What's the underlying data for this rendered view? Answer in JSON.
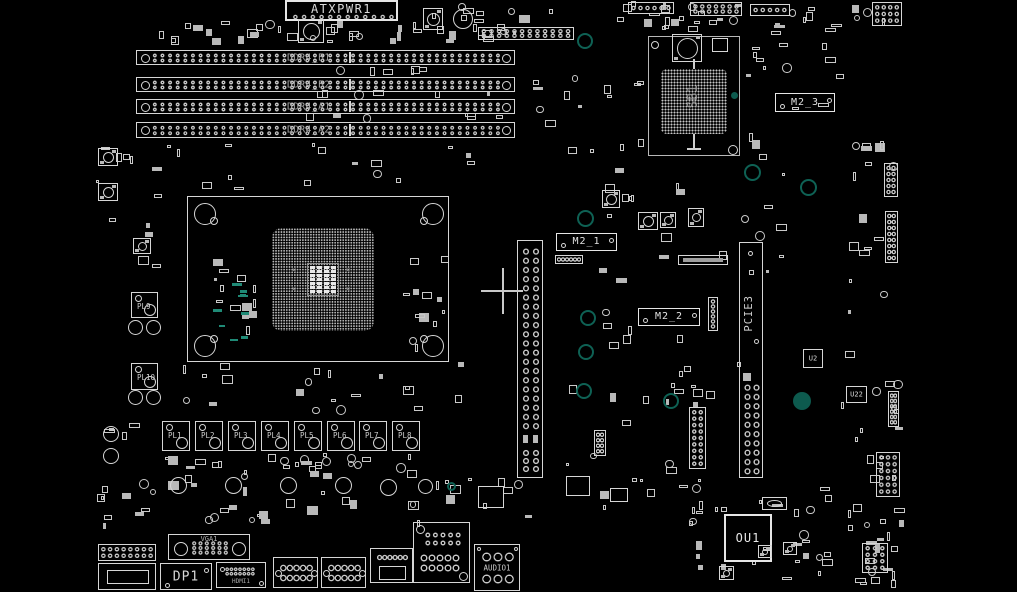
{
  "app": {
    "type": "pcb-boardview",
    "background": "#000000"
  },
  "colors": {
    "outline": "#d6d6d6",
    "bright": "#e6e6e6",
    "label": "#cfcfcf",
    "dim_label": "#a8a8a8",
    "teal_ring": "#0e6154",
    "teal_fill": "#0d5a4e",
    "teal_text": "#1f8a76",
    "cursor": "#c9c9c9"
  },
  "cursor": {
    "x": 503,
    "y": 291
  },
  "components": [
    {
      "t": "scatter",
      "x": 140,
      "y": 16,
      "w": 145,
      "h": 30,
      "n": 14
    },
    {
      "t": "scatter",
      "x": 285,
      "y": 20,
      "w": 250,
      "h": 24,
      "n": 20
    },
    {
      "t": "scatter",
      "x": 420,
      "y": 0,
      "w": 115,
      "h": 44,
      "n": 12
    },
    {
      "t": "scatter",
      "x": 548,
      "y": 0,
      "w": 215,
      "h": 26,
      "n": 13
    },
    {
      "t": "scatter",
      "x": 770,
      "y": 0,
      "w": 140,
      "h": 34,
      "n": 12
    },
    {
      "t": "scatter",
      "x": 95,
      "y": 140,
      "w": 68,
      "h": 128,
      "n": 12
    },
    {
      "t": "scatter",
      "x": 165,
      "y": 142,
      "w": 330,
      "h": 52,
      "n": 16
    },
    {
      "t": "scatter",
      "x": 520,
      "y": 48,
      "w": 125,
      "h": 135,
      "n": 16
    },
    {
      "t": "scatter",
      "x": 742,
      "y": 30,
      "w": 120,
      "h": 135,
      "n": 16
    },
    {
      "t": "scatter",
      "x": 640,
      "y": 16,
      "w": 100,
      "h": 18,
      "n": 8
    },
    {
      "t": "scatter",
      "x": 205,
      "y": 252,
      "w": 52,
      "h": 92,
      "n": 13
    },
    {
      "t": "scatter",
      "x": 400,
      "y": 245,
      "w": 52,
      "h": 108,
      "n": 12
    },
    {
      "t": "scatter",
      "x": 212,
      "y": 282,
      "w": 40,
      "h": 62,
      "n": 9,
      "teal": true
    },
    {
      "t": "scatter",
      "x": 168,
      "y": 362,
      "w": 300,
      "h": 52,
      "n": 20
    },
    {
      "t": "scatter",
      "x": 158,
      "y": 452,
      "w": 265,
      "h": 20,
      "n": 24
    },
    {
      "t": "scatter",
      "x": 95,
      "y": 420,
      "w": 70,
      "h": 118,
      "n": 12
    },
    {
      "t": "scatter",
      "x": 95,
      "y": 470,
      "w": 610,
      "h": 58,
      "n": 48
    },
    {
      "t": "scatter",
      "x": 690,
      "y": 478,
      "w": 168,
      "h": 112,
      "n": 28
    },
    {
      "t": "scatter",
      "x": 845,
      "y": 140,
      "w": 60,
      "h": 330,
      "n": 26
    },
    {
      "t": "scatter",
      "x": 840,
      "y": 400,
      "w": 65,
      "h": 185,
      "n": 14
    },
    {
      "t": "scatter",
      "x": 640,
      "y": 330,
      "w": 115,
      "h": 78,
      "n": 12
    },
    {
      "t": "scatter",
      "x": 560,
      "y": 300,
      "w": 118,
      "h": 175,
      "n": 13
    },
    {
      "t": "scatter",
      "x": 300,
      "y": 66,
      "w": 215,
      "h": 10,
      "n": 6
    },
    {
      "t": "scatter",
      "x": 300,
      "y": 90,
      "w": 215,
      "h": 8,
      "n": 6
    },
    {
      "t": "scatter",
      "x": 300,
      "y": 113,
      "w": 215,
      "h": 8,
      "n": 6
    },
    {
      "t": "scatter",
      "x": 555,
      "y": 170,
      "w": 245,
      "h": 125,
      "n": 20
    },
    {
      "t": "scatter",
      "x": 858,
      "y": 520,
      "w": 48,
      "h": 70,
      "n": 10
    },
    {
      "t": "atx",
      "x": 285,
      "y": 0,
      "w": 113,
      "h": 21,
      "label": "ATXPWR1"
    },
    {
      "t": "dimm",
      "x": 136,
      "y": 50,
      "w": 379,
      "h": 15,
      "label": "DDR4_B1"
    },
    {
      "t": "dimm",
      "x": 136,
      "y": 77,
      "w": 379,
      "h": 15,
      "label": "DDR4_B2"
    },
    {
      "t": "dimm",
      "x": 136,
      "y": 99,
      "w": 379,
      "h": 15,
      "label": "DDR4_A1"
    },
    {
      "t": "dimm",
      "x": 136,
      "y": 122,
      "w": 379,
      "h": 16,
      "label": "DDR4_A2"
    },
    {
      "t": "socket",
      "x": 187,
      "y": 196,
      "w": 262,
      "h": 166
    },
    {
      "t": "pciex",
      "x": 517,
      "y": 240,
      "w": 26,
      "h": 238
    },
    {
      "t": "pcie3",
      "x": 739,
      "y": 242,
      "w": 24,
      "h": 236,
      "label": "PCIE3"
    },
    {
      "t": "bga",
      "x": 648,
      "y": 36,
      "w": 92,
      "h": 120,
      "label": "SB1"
    },
    {
      "t": "m2",
      "x": 556,
      "y": 233,
      "w": 61,
      "h": 18,
      "label": "M2_1"
    },
    {
      "t": "m2",
      "x": 638,
      "y": 308,
      "w": 62,
      "h": 18,
      "label": "M2_2"
    },
    {
      "t": "m2",
      "x": 775,
      "y": 93,
      "w": 60,
      "h": 19,
      "label": "M2_3"
    },
    {
      "t": "choke",
      "x": 162,
      "y": 421,
      "w": 28,
      "h": 30,
      "label": "PL1"
    },
    {
      "t": "choke",
      "x": 195,
      "y": 421,
      "w": 28,
      "h": 30,
      "label": "PL2"
    },
    {
      "t": "choke",
      "x": 228,
      "y": 421,
      "w": 28,
      "h": 30,
      "label": "PL3"
    },
    {
      "t": "choke",
      "x": 261,
      "y": 421,
      "w": 28,
      "h": 30,
      "label": "PL4"
    },
    {
      "t": "choke",
      "x": 294,
      "y": 421,
      "w": 28,
      "h": 30,
      "label": "PL5"
    },
    {
      "t": "choke",
      "x": 327,
      "y": 421,
      "w": 28,
      "h": 30,
      "label": "PL6"
    },
    {
      "t": "choke",
      "x": 359,
      "y": 421,
      "w": 28,
      "h": 30,
      "label": "PL7"
    },
    {
      "t": "choke",
      "x": 392,
      "y": 421,
      "w": 28,
      "h": 30,
      "label": "PL8"
    },
    {
      "t": "choke",
      "x": 131,
      "y": 292,
      "w": 27,
      "h": 26,
      "label": "PL9"
    },
    {
      "t": "choke",
      "x": 131,
      "y": 363,
      "w": 27,
      "h": 27,
      "label": "PL10"
    },
    {
      "t": "ou1chip",
      "x": 724,
      "y": 514,
      "w": 48,
      "h": 48,
      "label": "OU1"
    },
    {
      "t": "chip",
      "x": 803,
      "y": 349,
      "w": 20,
      "h": 19,
      "label": "U2"
    },
    {
      "t": "chip",
      "x": 846,
      "y": 386,
      "w": 21,
      "h": 17,
      "label": "U22"
    },
    {
      "t": "vga",
      "x": 168,
      "y": 534,
      "w": 82,
      "h": 26,
      "label": "VGA1"
    },
    {
      "t": "dp",
      "x": 160,
      "y": 563,
      "w": 52,
      "h": 27,
      "label": "DP1"
    },
    {
      "t": "hdmi",
      "x": 216,
      "y": 562,
      "w": 50,
      "h": 26,
      "label": "HDMI1"
    },
    {
      "t": "dsub",
      "x": 273,
      "y": 557,
      "w": 45,
      "h": 31
    },
    {
      "t": "dsub",
      "x": 321,
      "y": 557,
      "w": 45,
      "h": 31
    },
    {
      "t": "stack",
      "x": 370,
      "y": 548,
      "w": 43,
      "h": 35
    },
    {
      "t": "lan",
      "x": 413,
      "y": 522,
      "w": 57,
      "h": 61
    },
    {
      "t": "audio",
      "x": 474,
      "y": 544,
      "w": 46,
      "h": 47,
      "label": "AUDIO1"
    },
    {
      "t": "pins",
      "x": 98,
      "y": 544,
      "w": 58,
      "h": 17,
      "cols": 8,
      "rows": 2
    },
    {
      "t": "stack2",
      "x": 98,
      "y": 563,
      "w": 58,
      "h": 27
    },
    {
      "t": "xtal",
      "x": 762,
      "y": 497,
      "w": 25,
      "h": 13
    },
    {
      "t": "pins",
      "x": 872,
      "y": 2,
      "w": 30,
      "h": 24,
      "cols": 4,
      "rows": 3
    },
    {
      "t": "pins",
      "x": 884,
      "y": 163,
      "w": 14,
      "h": 34,
      "cols": 2,
      "rows": 5
    },
    {
      "t": "pins",
      "x": 885,
      "y": 211,
      "w": 13,
      "h": 52,
      "cols": 2,
      "rows": 8
    },
    {
      "t": "pins",
      "x": 888,
      "y": 391,
      "w": 11,
      "h": 36,
      "cols": 2,
      "rows": 6
    },
    {
      "t": "pins",
      "x": 876,
      "y": 452,
      "w": 24,
      "h": 45,
      "cols": 3,
      "rows": 6
    },
    {
      "t": "pins",
      "x": 862,
      "y": 543,
      "w": 26,
      "h": 30,
      "cols": 3,
      "rows": 4
    },
    {
      "t": "pins",
      "x": 689,
      "y": 407,
      "w": 17,
      "h": 62,
      "cols": 2,
      "rows": 9
    },
    {
      "t": "pins",
      "x": 628,
      "y": 2,
      "w": 46,
      "h": 12,
      "cols": 6,
      "rows": 1
    },
    {
      "t": "pins",
      "x": 690,
      "y": 2,
      "w": 52,
      "h": 14,
      "cols": 7,
      "rows": 2
    },
    {
      "t": "pins",
      "x": 750,
      "y": 4,
      "w": 40,
      "h": 12,
      "cols": 5,
      "rows": 1
    },
    {
      "t": "pins",
      "x": 478,
      "y": 27,
      "w": 96,
      "h": 13,
      "cols": 12,
      "rows": 2
    },
    {
      "t": "pins",
      "x": 555,
      "y": 255,
      "w": 28,
      "h": 9,
      "cols": 6,
      "rows": 1
    },
    {
      "t": "pins",
      "x": 708,
      "y": 297,
      "w": 10,
      "h": 34,
      "cols": 1,
      "rows": 6
    },
    {
      "t": "pins",
      "x": 594,
      "y": 430,
      "w": 12,
      "h": 26,
      "cols": 2,
      "rows": 4
    },
    {
      "t": "coil",
      "x": 298,
      "y": 19,
      "w": 26,
      "h": 24
    },
    {
      "t": "coil",
      "x": 423,
      "y": 8,
      "w": 20,
      "h": 22
    },
    {
      "t": "coil",
      "x": 672,
      "y": 34,
      "w": 30,
      "h": 28
    },
    {
      "t": "coil",
      "x": 98,
      "y": 148,
      "w": 20,
      "h": 18
    },
    {
      "t": "coil",
      "x": 98,
      "y": 183,
      "w": 20,
      "h": 18
    },
    {
      "t": "coil",
      "x": 133,
      "y": 238,
      "w": 18,
      "h": 16
    },
    {
      "t": "coil",
      "x": 602,
      "y": 190,
      "w": 18,
      "h": 18
    },
    {
      "t": "coil",
      "x": 638,
      "y": 212,
      "w": 20,
      "h": 18
    },
    {
      "t": "coil",
      "x": 660,
      "y": 212,
      "w": 16,
      "h": 16
    },
    {
      "t": "coil",
      "x": 688,
      "y": 208,
      "w": 16,
      "h": 19
    },
    {
      "t": "coil",
      "x": 719,
      "y": 566,
      "w": 15,
      "h": 14
    },
    {
      "t": "coil",
      "x": 758,
      "y": 545,
      "w": 14,
      "h": 13
    },
    {
      "t": "coil",
      "x": 783,
      "y": 542,
      "w": 14,
      "h": 13
    },
    {
      "t": "rcoil",
      "x": 170,
      "y": 477,
      "d": 17
    },
    {
      "t": "rcoil",
      "x": 225,
      "y": 477,
      "d": 17
    },
    {
      "t": "rcoil",
      "x": 280,
      "y": 477,
      "d": 17
    },
    {
      "t": "rcoil",
      "x": 335,
      "y": 477,
      "d": 17
    },
    {
      "t": "rcoil",
      "x": 380,
      "y": 479,
      "d": 17
    },
    {
      "t": "rcoil",
      "x": 418,
      "y": 479,
      "d": 15
    },
    {
      "t": "rcoil",
      "x": 128,
      "y": 320,
      "d": 15
    },
    {
      "t": "rcoil",
      "x": 146,
      "y": 320,
      "d": 15
    },
    {
      "t": "rcoil",
      "x": 128,
      "y": 390,
      "d": 15
    },
    {
      "t": "rcoil",
      "x": 146,
      "y": 390,
      "d": 15
    },
    {
      "t": "rcoil",
      "x": 103,
      "y": 426,
      "d": 16
    },
    {
      "t": "rcoil",
      "x": 103,
      "y": 448,
      "d": 16
    },
    {
      "t": "rcoil",
      "x": 453,
      "y": 9,
      "d": 20
    },
    {
      "t": "hole",
      "x": 585,
      "y": 41,
      "d": 16
    },
    {
      "t": "hole",
      "x": 585,
      "y": 218,
      "d": 17
    },
    {
      "t": "hole",
      "x": 752,
      "y": 172,
      "d": 17
    },
    {
      "t": "hole",
      "x": 808,
      "y": 187,
      "d": 17
    },
    {
      "t": "hole",
      "x": 588,
      "y": 318,
      "d": 16
    },
    {
      "t": "hole",
      "x": 586,
      "y": 352,
      "d": 16
    },
    {
      "t": "hole",
      "x": 584,
      "y": 391,
      "d": 16
    },
    {
      "t": "hole",
      "x": 671,
      "y": 401,
      "d": 16
    },
    {
      "t": "hole",
      "x": 802,
      "y": 401,
      "d": 18,
      "fill": true
    },
    {
      "t": "hole",
      "x": 451,
      "y": 486,
      "d": 9
    },
    {
      "t": "hole",
      "x": 734,
      "y": 95,
      "d": 7,
      "fill": true
    },
    {
      "t": "slim",
      "x": 678,
      "y": 255,
      "w": 50,
      "h": 10
    },
    {
      "t": "rect",
      "x": 712,
      "y": 38,
      "w": 16,
      "h": 14
    },
    {
      "t": "rect",
      "x": 478,
      "y": 486,
      "w": 26,
      "h": 22
    },
    {
      "t": "rect",
      "x": 566,
      "y": 476,
      "w": 24,
      "h": 20
    },
    {
      "t": "rect",
      "x": 610,
      "y": 488,
      "w": 18,
      "h": 14
    },
    {
      "t": "cross",
      "x": 503,
      "y": 291
    }
  ]
}
